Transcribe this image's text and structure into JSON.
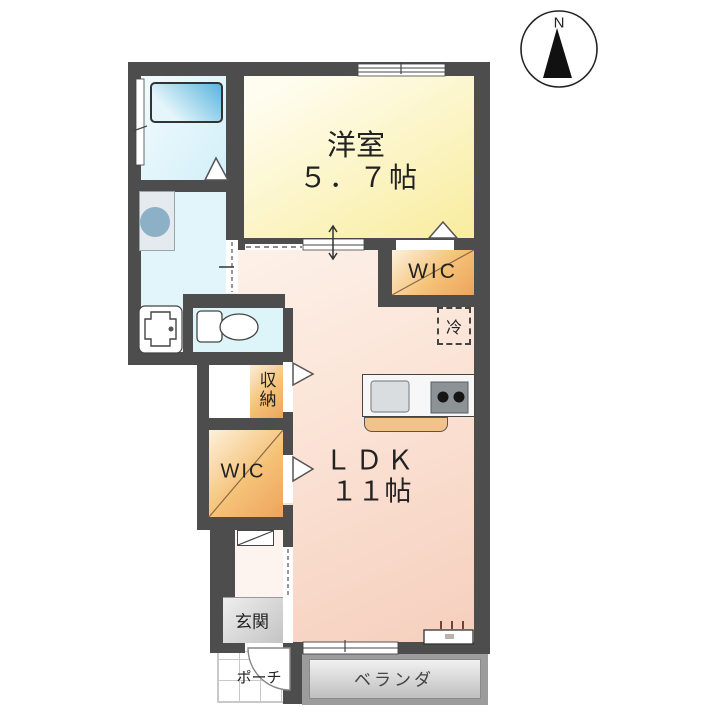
{
  "plan": {
    "compass": {
      "label": "N"
    },
    "rooms": {
      "western_room": {
        "name": "洋室",
        "size": "５．７帖"
      },
      "ldk": {
        "name": "ＬＤＫ",
        "size": "１１帖"
      },
      "wic_upper": {
        "label": "WIC"
      },
      "wic_lower": {
        "label": "WIC"
      },
      "storage": {
        "label": "収納"
      },
      "refrigerator_space": {
        "label": "冷"
      },
      "entrance": {
        "label": "玄関"
      },
      "porch": {
        "label": "ポーチ"
      },
      "veranda": {
        "label": "ベランダ"
      }
    },
    "fixtures": {
      "bathtub": "bathtub",
      "washing_machine_pan": "washing-machine-pan",
      "washbasin": "washbasin-vanity",
      "toilet": "toilet",
      "kitchen_sink": "kitchen-sink",
      "stove": "two-burner-stove",
      "shoe_cabinet": "shoe-cabinet",
      "vent": "wall-vent"
    },
    "colors": {
      "wall": "#4d4d4d",
      "western_room": "#f9eda1",
      "ldk": "#f5cebc",
      "closet": "#eda45c",
      "bath": "#d2eff9",
      "entrance": "#c4c4c4"
    }
  }
}
